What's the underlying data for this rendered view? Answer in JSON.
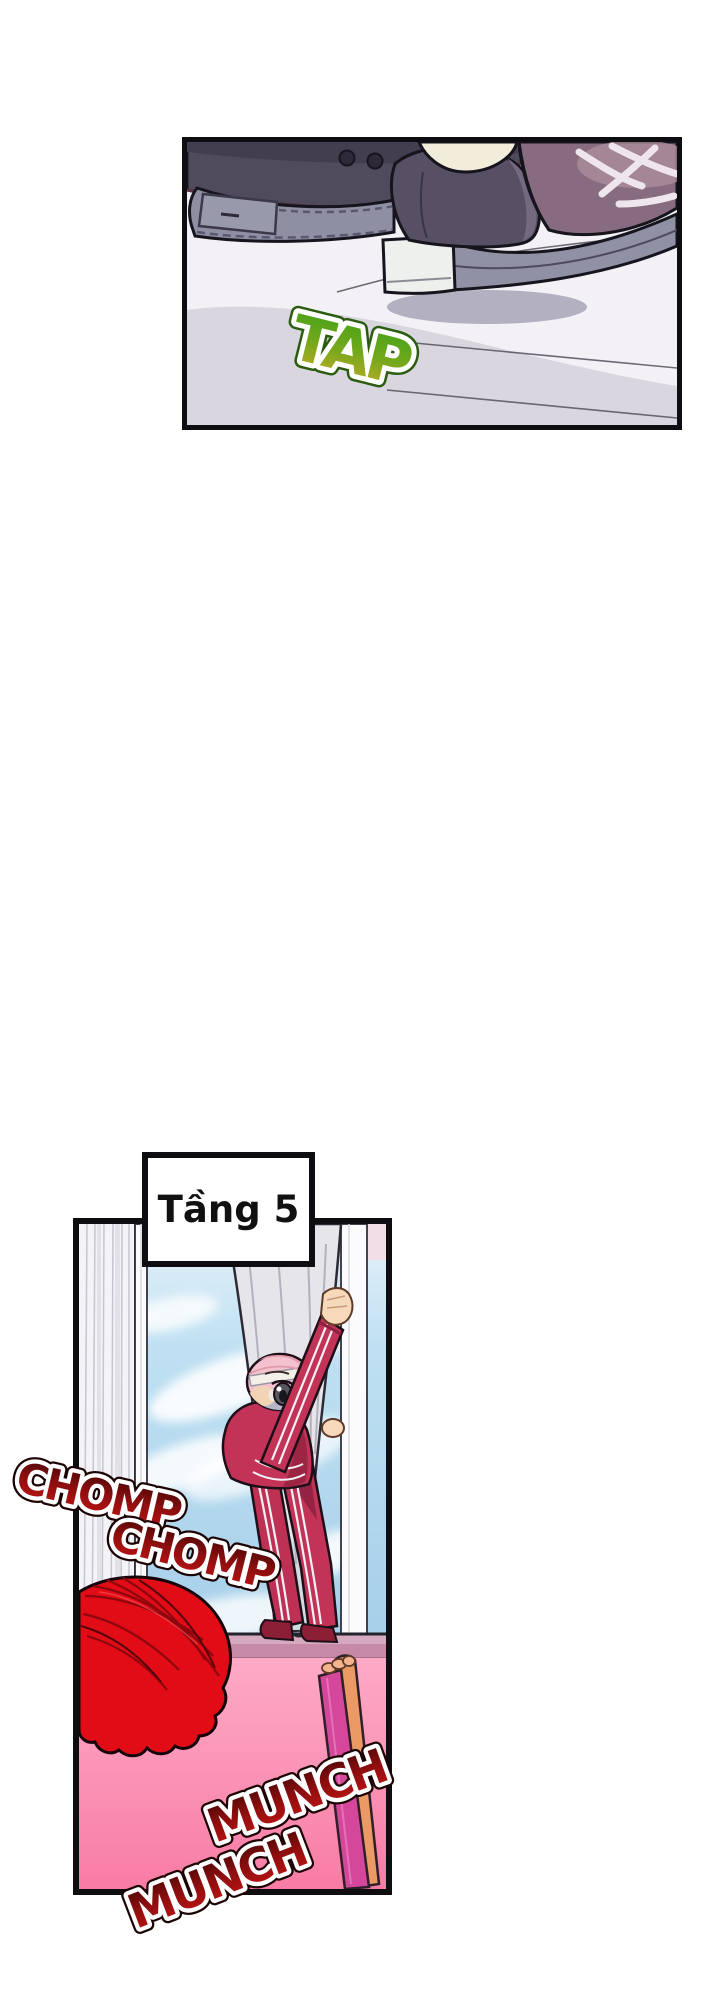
{
  "page": {
    "width": 720,
    "height": 2000,
    "background": "#ffffff"
  },
  "caption_box": {
    "text": "Tầng 5"
  },
  "sfx": {
    "tap": "TAP",
    "chomp1": "CHOMP",
    "chomp2": "CHOMP",
    "munch1": "MUNCH",
    "munch2": "MUNCH"
  },
  "panels": {
    "top": {
      "scene": "two sneakers stepping onto a white windowsill"
    },
    "bottom": {
      "scene": "person in red tracksuit climbing in window holding curtain, red-haired watcher below"
    }
  },
  "colors": {
    "panel_border": "#0e0e12",
    "tap_green_top": "#3fa117",
    "tap_yellow_bottom": "#c4ab26",
    "sfx_red_dark_top": "#450707",
    "sfx_red_bright_bottom": "#c41414",
    "sky_blue": "#a6cfe9",
    "wall_pink_top": "#feaac6",
    "wall_pink_bottom": "#f87ca5",
    "tracksuit_red": "#c23357",
    "hair_red": "#e10c16",
    "hair_pink": "#f4c2ce",
    "chair_orange": "#eb9a66",
    "chair_magenta": "#d4479a",
    "sneaker_dark": "#504a5d",
    "sole_grey": "#8f8fa3",
    "curtain_grey": "#e6e5ea"
  }
}
